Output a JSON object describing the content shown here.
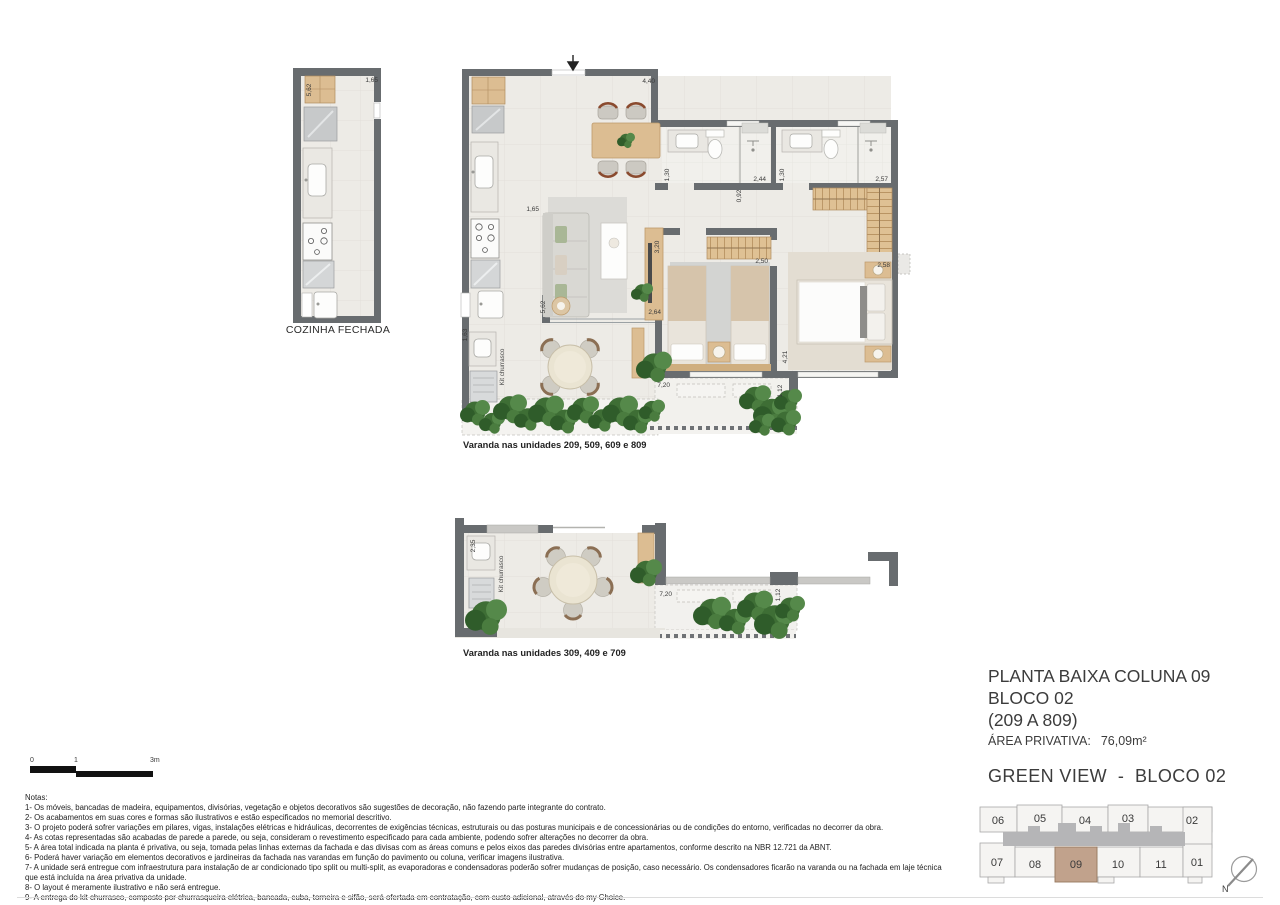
{
  "title_block": {
    "line1": "PLANTA BAIXA COLUNA 09",
    "line2": "BLOCO 02",
    "line3": "(209 A 809)",
    "area_label": "ÁREA PRIVATIVA:",
    "area_value": "76,09m²",
    "project_title": "GREEN VIEW  -  BLOCO 02"
  },
  "captions": {
    "cozinha_fechada": "COZINHA FECHADA",
    "varanda_main": "Varanda nas unidades 209, 509, 609 e 809",
    "varanda_alt": "Varanda nas unidades 309, 409 e 709"
  },
  "plan_labels": {
    "kit_churrasco_main": "Kit churrasco",
    "kit_churrasco_alt": "Kit churrasco",
    "north": "N"
  },
  "dimensions": {
    "main": {
      "living_top": "4,40",
      "bath1_width": "1,30",
      "bath1_depth": "2,44",
      "bath2_width": "1,30",
      "bath2_depth": "2,57",
      "hall_width": "0,92",
      "entry_wall": "1,65",
      "bed1_width": "3,20",
      "bed1_depth": "2,50",
      "living_wall": "2,64",
      "bed2_nook": "2,58",
      "bed2_depth": "4,21",
      "kitchen_depth": "5,62",
      "service_width": "1,63",
      "terrace_length": "7,20",
      "ledge_width": "1,12"
    },
    "cozinha": {
      "depth": "5,62",
      "width": "1,65"
    },
    "varanda_alt": {
      "width": "2,35",
      "terrace_length": "7,20",
      "ledge_width": "1,12"
    }
  },
  "scale_bar": {
    "tick0": "0",
    "tick1": "1",
    "tick2": "3m"
  },
  "notes": {
    "heading": "Notas:",
    "lines": [
      "1- Os móveis, bancadas de madeira, equipamentos, divisórias, vegetação e objetos decorativos são sugestões de decoração, não fazendo parte integrante do contrato.",
      "2- Os acabamentos em suas cores e formas são ilustrativos e estão especificados no memorial descritivo.",
      "3- O projeto poderá sofrer variações em pilares, vigas, instalações elétricas e hidráulicas, decorrentes de exigências técnicas, estruturais ou das posturas municipais e de concessionárias ou de condições do entorno, verificadas no decorrer da obra.",
      "4- As cotas representadas são acabadas de parede a parede, ou seja, consideram o revestimento especificado para cada ambiente, podendo sofrer alterações no decorrer da obra.",
      "5- A área total indicada na planta é privativa, ou seja, tomada pelas linhas externas da fachada e das divisas com as áreas comuns e pelos eixos das paredes divisórias entre apartamentos, conforme descrito na NBR 12.721 da ABNT.",
      "6- Poderá haver variação em elementos decorativos e jardineiras da fachada nas varandas em função do pavimento ou coluna, verificar imagens ilustrativa.",
      "7- A unidade será entregue com infraestrutura para instalação de ar condicionado tipo split ou multi-split, as evaporadoras e condensadoras poderão sofrer mudanças de posição, caso necessário. Os condensadores ficarão na varanda ou na fachada em laje técnica",
      "que está incluída na área privativa da unidade.",
      "8- O layout é meramente ilustrativo e não será entregue.",
      "9- A entrega do kit churrasco, composto por churrasqueira elétrica, bancada, cuba, torneira e sifão, será ofertada em contratação, com custo adicional, através do my Choice."
    ]
  },
  "key_plan": {
    "top_row": [
      "06",
      "05",
      "04",
      "03",
      "02"
    ],
    "bottom_row": [
      "07",
      "08",
      "09",
      "10",
      "11",
      "01"
    ],
    "highlighted_unit": "09"
  },
  "colors": {
    "wall": "#686c6f",
    "wood": "#dcbd92",
    "floor": "#edebe6",
    "plant": "#4a7c3f",
    "unit_highlight": "#c1a28c",
    "corridor": "#b5b5b7"
  }
}
